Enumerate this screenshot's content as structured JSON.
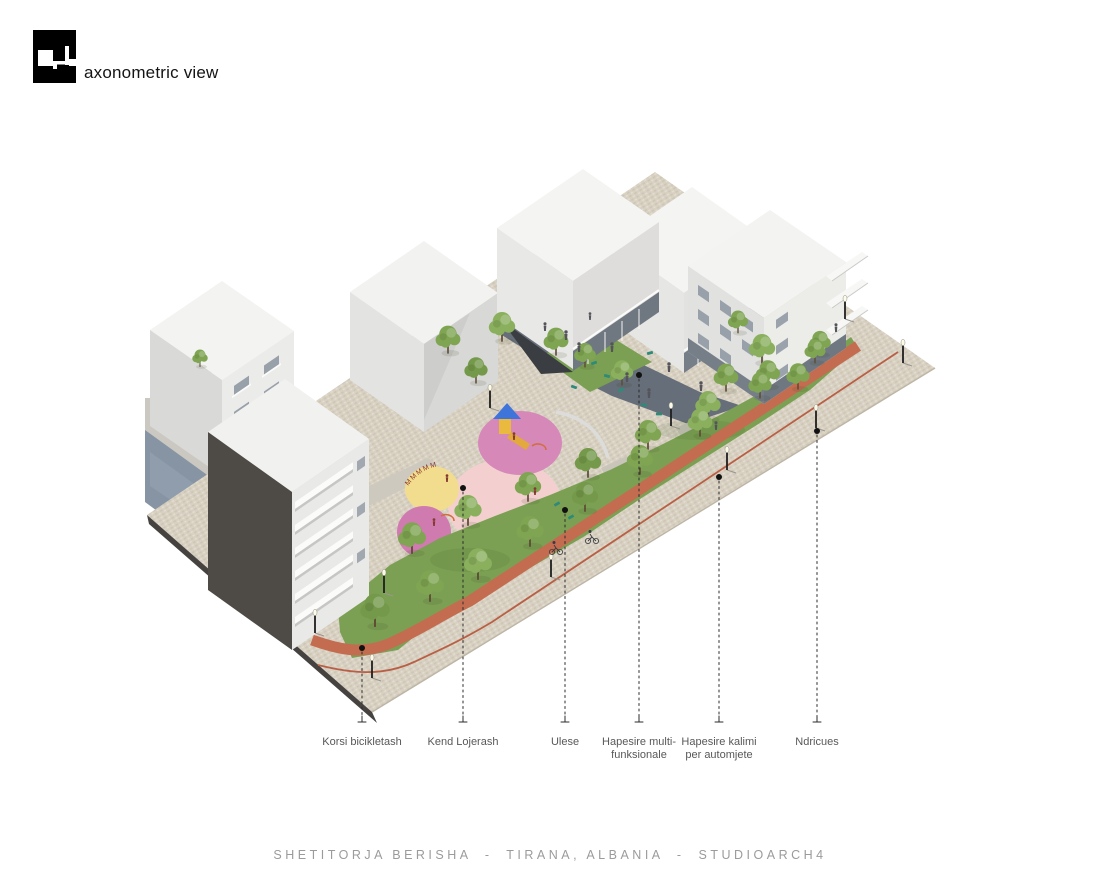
{
  "header": {
    "view_label": "axonometric view"
  },
  "footer": {
    "project_title": "SHETITORJA BERISHA  -  TIRANA, ALBANIA  -  STUDIOARCH4"
  },
  "legend": {
    "items": [
      {
        "id": "korsi-bicikletash",
        "line1": "Korsi bicikletash",
        "line2": ""
      },
      {
        "id": "kend-lojerash",
        "line1": "Kend Lojerash",
        "line2": ""
      },
      {
        "id": "ulese",
        "line1": "Ulese",
        "line2": ""
      },
      {
        "id": "hapesire-multifunksionale",
        "line1": "Hapesire multi-",
        "line2": "funksionale"
      },
      {
        "id": "hapesire-kalimi-per-automjete",
        "line1": "Hapesire kalimi",
        "line2": "per automjete"
      },
      {
        "id": "ndricues",
        "line1": "Ndricues",
        "line2": ""
      }
    ]
  },
  "scene": {
    "playground_letters": "MMMMM",
    "colors": {
      "ground": "#d8d1c2",
      "context_gray": "#cbc8c2",
      "context_blue": "#8794a4",
      "slab_edge": "#454240",
      "plaza_dark": "#666e79",
      "grass": "#7ba053",
      "tree": "#7fa553",
      "bike_lane": "#c46c50",
      "bike_line": "#b95f45",
      "circle_yellow": "#f2dd8e",
      "circle_pink": "#f3d0cf",
      "circle_magenta": "#d689b9",
      "circle_magenta_dark": "#cf7bb0",
      "building_dark": "#4e4b47",
      "figure": "#54545a",
      "kid_figure": "#83392f",
      "bench": "#2e8b79"
    }
  }
}
